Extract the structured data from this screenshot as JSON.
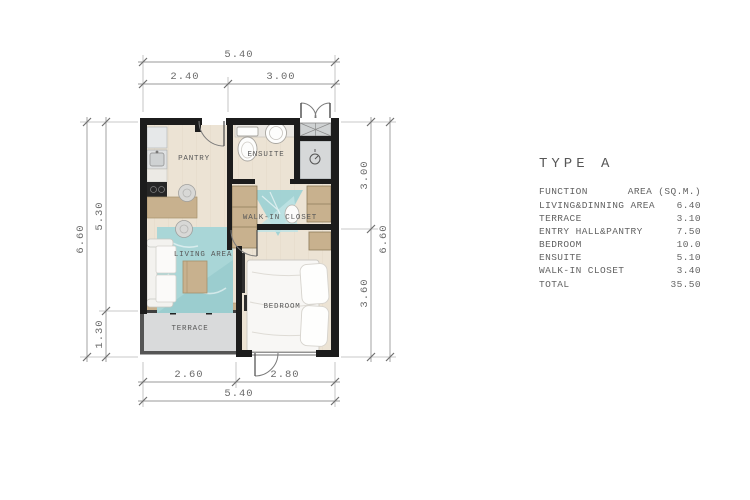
{
  "plan": {
    "rooms": [
      {
        "id": "pantry",
        "label": "PANTRY"
      },
      {
        "id": "ensuite",
        "label": "ENSUITE"
      },
      {
        "id": "walk_in_closet",
        "label": "WALK-IN CLOSET"
      },
      {
        "id": "living_area",
        "label": "LIVING AREA"
      },
      {
        "id": "terrace",
        "label": "TERRACE"
      },
      {
        "id": "bedroom",
        "label": "BEDROOM"
      }
    ],
    "dimensions": {
      "top_total": "5.40",
      "top_seg1": "2.40",
      "top_seg2": "3.00",
      "bottom_seg1": "2.60",
      "bottom_seg2": "2.80",
      "bottom_total": "5.40",
      "left_total": "6.60",
      "left_seg1": "5.30",
      "left_seg2": "1.30",
      "right_seg1": "3.00",
      "right_seg2": "3.60",
      "right_total": "6.60"
    },
    "colors": {
      "wall": "#1c1c1c",
      "floor": "#ece3d4",
      "wood_furniture": "#c8b18e",
      "rug_teal": "#a9d6d7",
      "terrace_gray": "#d9dadb",
      "dimension_gray": "#9a9a9a"
    }
  },
  "legend": {
    "title": "TYPE A",
    "columns": {
      "function": "FUNCTION",
      "area": "AREA (SQ.M.)"
    },
    "rows": [
      {
        "function": "LIVING&DINNING AREA",
        "area": "6.40"
      },
      {
        "function": "TERRACE",
        "area": "3.10"
      },
      {
        "function": "ENTRY HALL&PANTRY",
        "area": "7.50"
      },
      {
        "function": "BEDROOM",
        "area": "10.0"
      },
      {
        "function": "ENSUITE",
        "area": "5.10"
      },
      {
        "function": "WALK-IN CLOSET",
        "area": "3.40"
      }
    ],
    "total": {
      "function": "TOTAL",
      "area": "35.50"
    }
  }
}
